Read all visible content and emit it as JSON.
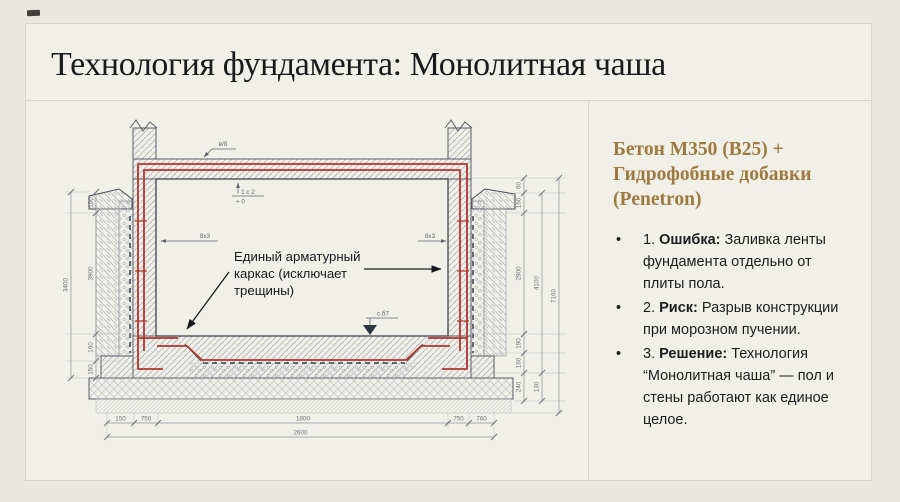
{
  "page": {
    "title": "Технология фундамента: Монолитная чаша"
  },
  "right_panel": {
    "heading_lines": [
      "Бетон М350 (В25) +",
      "Гидрофобные добавки",
      "(Penetron)"
    ],
    "bullet_char": "•",
    "bullets": [
      {
        "num": "1.",
        "bold": "Ошибка:",
        "text": "Заливка ленты фундамента отдельно от плиты пола."
      },
      {
        "num": "2.",
        "bold": "Риск:",
        "text": "Разрыв конструкции при морозном пучении."
      },
      {
        "num": "3.",
        "bold": "Решение:",
        "text": "Технология “Монолитная чаша” — пол и стены работают как единое целое."
      }
    ]
  },
  "drawing": {
    "callout_lines": [
      "Единый арматурный",
      "каркас (исключает",
      "трещины)"
    ],
    "labels": {
      "top_section": "в/б",
      "level_top": "1 с 2",
      "level_zero": "+ 0",
      "rebar_left": "8х3",
      "rebar_right": "8х3",
      "floor_level": "с.б7"
    },
    "dims": {
      "bottom": [
        "150",
        "750",
        "1800",
        "750",
        "760"
      ],
      "bottom_total": "2600",
      "left_inner": [
        "100",
        "3900",
        "160",
        "150"
      ],
      "left_outer": "3400",
      "right_inner": [
        "60",
        "160",
        "2900",
        "190",
        "160",
        "240"
      ],
      "right_mid": [
        "4100",
        "130"
      ],
      "right_outer": "7160"
    },
    "colors": {
      "rebar": "#b2362e",
      "membrane": "#39404e",
      "outline": "#5a5f67",
      "accent": "#9f7a3e",
      "background": "#f0efe8"
    }
  }
}
